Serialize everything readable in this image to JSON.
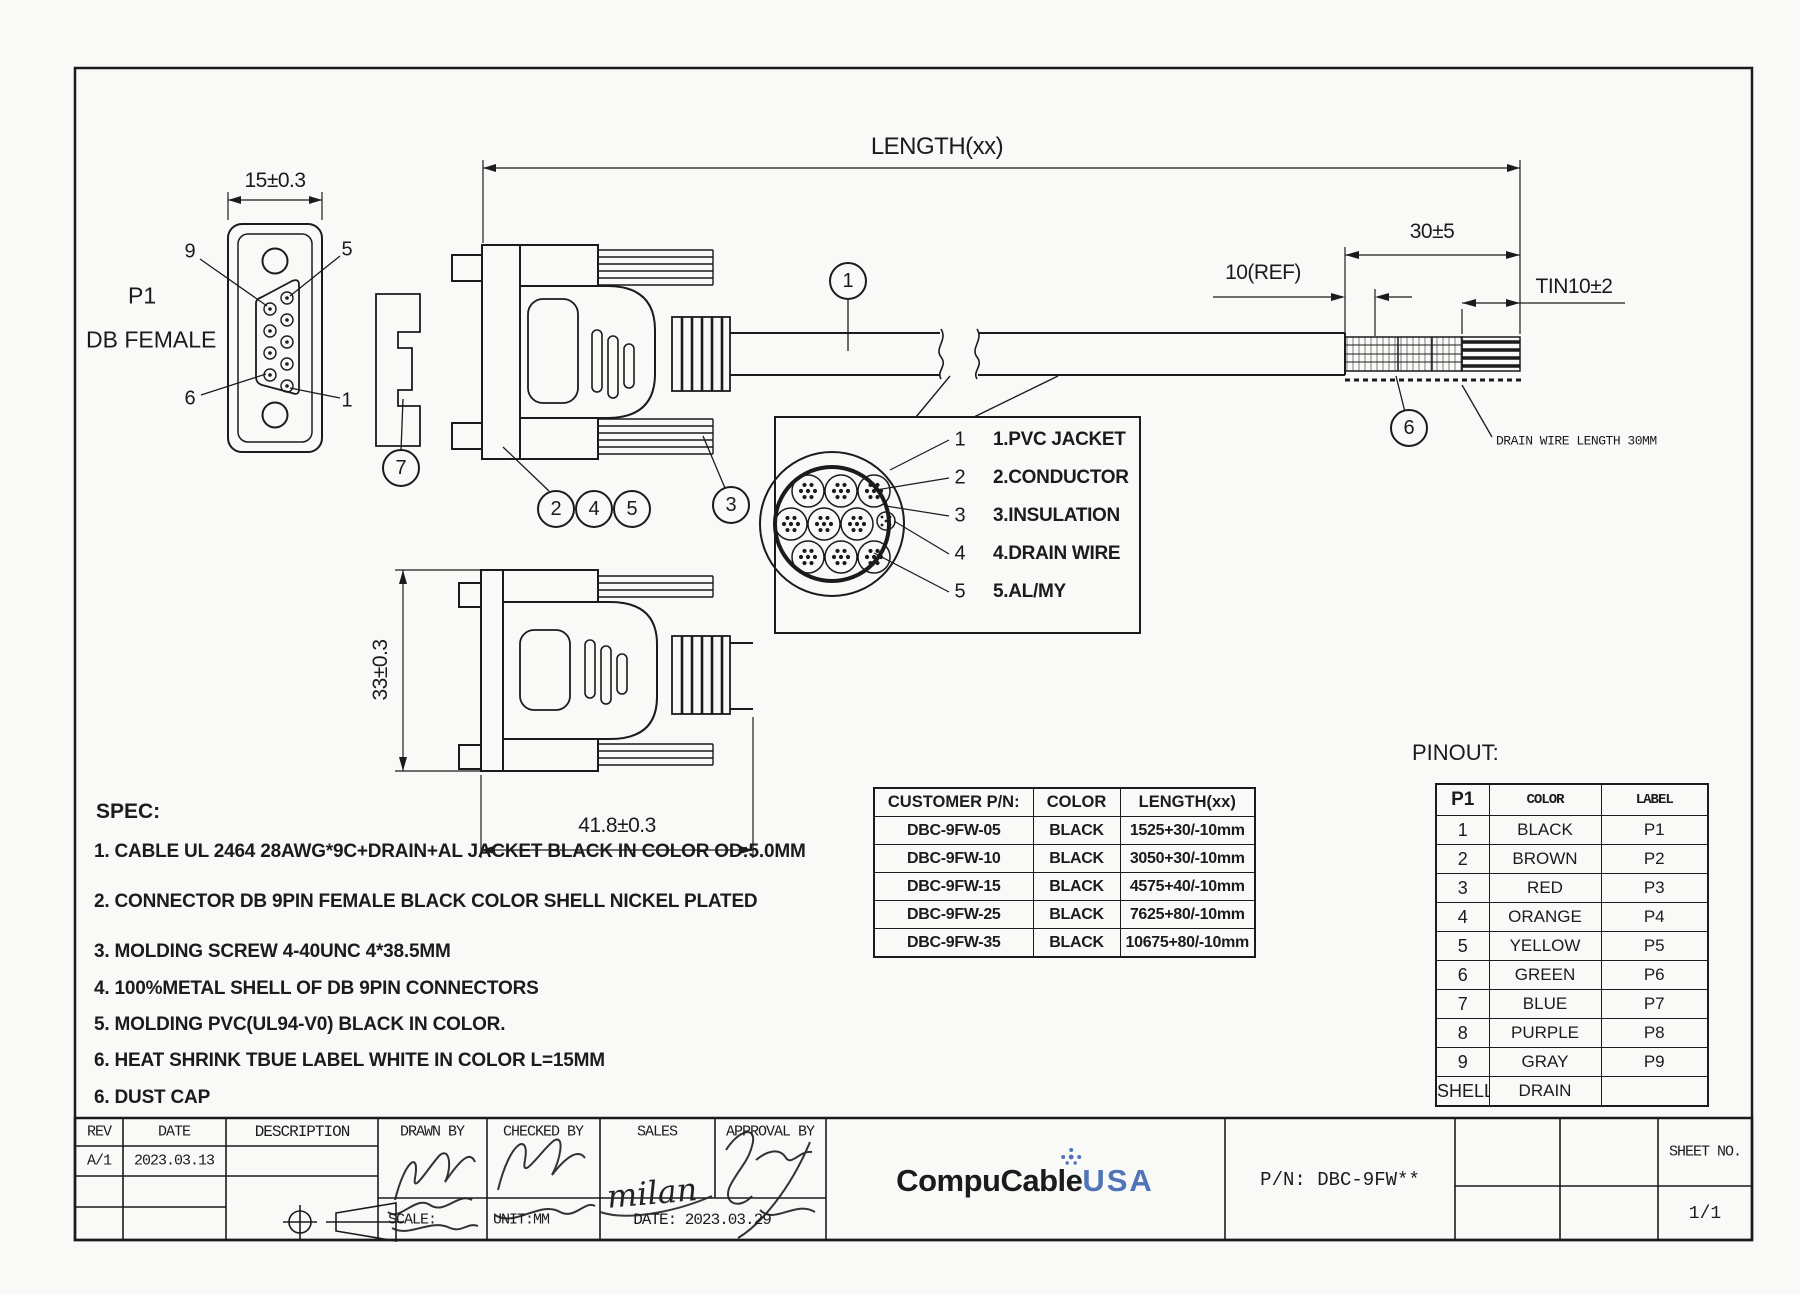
{
  "views": {
    "front": {
      "p1": "P1",
      "type": "DB FEMALE",
      "width_dim": "15±0.3",
      "pin_tl": "9",
      "pin_tr": "5",
      "pin_bl": "6",
      "pin_br": "1"
    },
    "side": {
      "height_dim": "33±0.3",
      "length_dim": "41.8±0.3"
    },
    "cable": {
      "length_dim": "LENGTH(xx)",
      "strip_dim": "30±5",
      "ref_dim": "10(REF)",
      "tin_dim": "TIN10±2",
      "drain_note": "DRAIN WIRE LENGTH 30MM"
    }
  },
  "callouts": {
    "c1": "1",
    "c2": "2",
    "c3": "3",
    "c4": "4",
    "c5": "5",
    "c6": "6",
    "c7": "7"
  },
  "cross_section": {
    "items": [
      {
        "num": "1",
        "label": "1.PVC JACKET"
      },
      {
        "num": "2",
        "label": "2.CONDUCTOR"
      },
      {
        "num": "3",
        "label": "3.INSULATION"
      },
      {
        "num": "4",
        "label": "4.DRAIN WIRE"
      },
      {
        "num": "5",
        "label": "5.AL/MY"
      }
    ]
  },
  "spec": {
    "title": "SPEC:",
    "items": [
      "1. CABLE UL 2464 28AWG*9C+DRAIN+AL JACKET BLACK IN COLOR OD:5.0MM",
      "2. CONNECTOR DB 9PIN FEMALE BLACK COLOR SHELL NICKEL PLATED",
      "3. MOLDING SCREW 4-40UNC 4*38.5MM",
      "4. 100%METAL SHELL OF DB 9PIN CONNECTORS",
      "5. MOLDING PVC(UL94-V0) BLACK IN COLOR.",
      "6. HEAT SHRINK TBUE LABEL WHITE IN COLOR L=15MM",
      "6. DUST CAP"
    ]
  },
  "customer_table": {
    "headers": [
      "CUSTOMER P/N:",
      "COLOR",
      "LENGTH(xx)"
    ],
    "rows": [
      [
        "DBC-9FW-05",
        "BLACK",
        "1525+30/-10mm"
      ],
      [
        "DBC-9FW-10",
        "BLACK",
        "3050+30/-10mm"
      ],
      [
        "DBC-9FW-15",
        "BLACK",
        "4575+40/-10mm"
      ],
      [
        "DBC-9FW-25",
        "BLACK",
        "7625+80/-10mm"
      ],
      [
        "DBC-9FW-35",
        "BLACK",
        "10675+80/-10mm"
      ]
    ]
  },
  "pinout": {
    "title": "PINOUT:",
    "headers": [
      "P1",
      "COLOR",
      "LABEL"
    ],
    "rows": [
      [
        "1",
        "BLACK",
        "P1"
      ],
      [
        "2",
        "BROWN",
        "P2"
      ],
      [
        "3",
        "RED",
        "P3"
      ],
      [
        "4",
        "ORANGE",
        "P4"
      ],
      [
        "5",
        "YELLOW",
        "P5"
      ],
      [
        "6",
        "GREEN",
        "P6"
      ],
      [
        "7",
        "BLUE",
        "P7"
      ],
      [
        "8",
        "PURPLE",
        "P8"
      ],
      [
        "9",
        "GRAY",
        "P9"
      ],
      [
        "SHELL",
        "DRAIN",
        ""
      ]
    ]
  },
  "title_block": {
    "rev_h": "REV",
    "date_h": "DATE",
    "desc_h": "DESCRIPTION",
    "drawn_h": "DRAWN BY",
    "checked_h": "CHECKED BY",
    "sales_h": "SALES",
    "approval_h": "APPROVAL BY",
    "rev": "A/1",
    "rev_date": "2023.03.13",
    "scale": "SCALE:",
    "unit": "UNIT:MM",
    "date": "DATE: 2023.03.29",
    "company": "CompuCable",
    "company_suffix": "USA",
    "pn": "P/N: DBC-9FW**",
    "sheet_h": "SHEET NO.",
    "sheet": "1/1",
    "sales_sig": "milan"
  }
}
